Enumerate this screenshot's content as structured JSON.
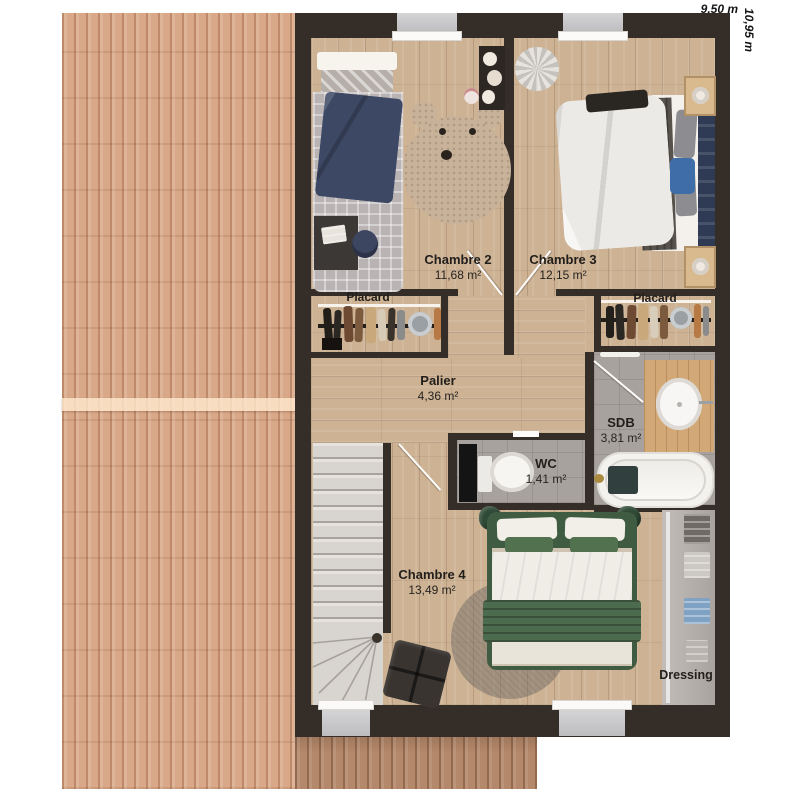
{
  "dimensions": {
    "width": "9,50 m",
    "height": "10,95 m"
  },
  "rooms": {
    "chambre2": {
      "name": "Chambre 2",
      "area": "11,68 m²"
    },
    "chambre3": {
      "name": "Chambre 3",
      "area": "12,15 m²"
    },
    "placard_left": {
      "name": "Placard"
    },
    "placard_right": {
      "name": "Placard"
    },
    "palier": {
      "name": "Palier",
      "area": "4,36 m²"
    },
    "sdb": {
      "name": "SDB",
      "area": "3,81 m²"
    },
    "wc": {
      "name": "WC",
      "area": "1,41 m²"
    },
    "chambre4": {
      "name": "Chambre 4",
      "area": "13,49 m²"
    },
    "dressing": {
      "name": "Dressing"
    }
  },
  "colors": {
    "wall": "#352d27",
    "roof_left": "#d9a888",
    "roof_bottom": "#b4886a",
    "wood_floor": "#cdb294",
    "tile_floor": "#a8a29e",
    "bed_green": "#4d6b4e",
    "bed_navy": "#3d4964",
    "stair_tread": "#d8d4cf"
  }
}
